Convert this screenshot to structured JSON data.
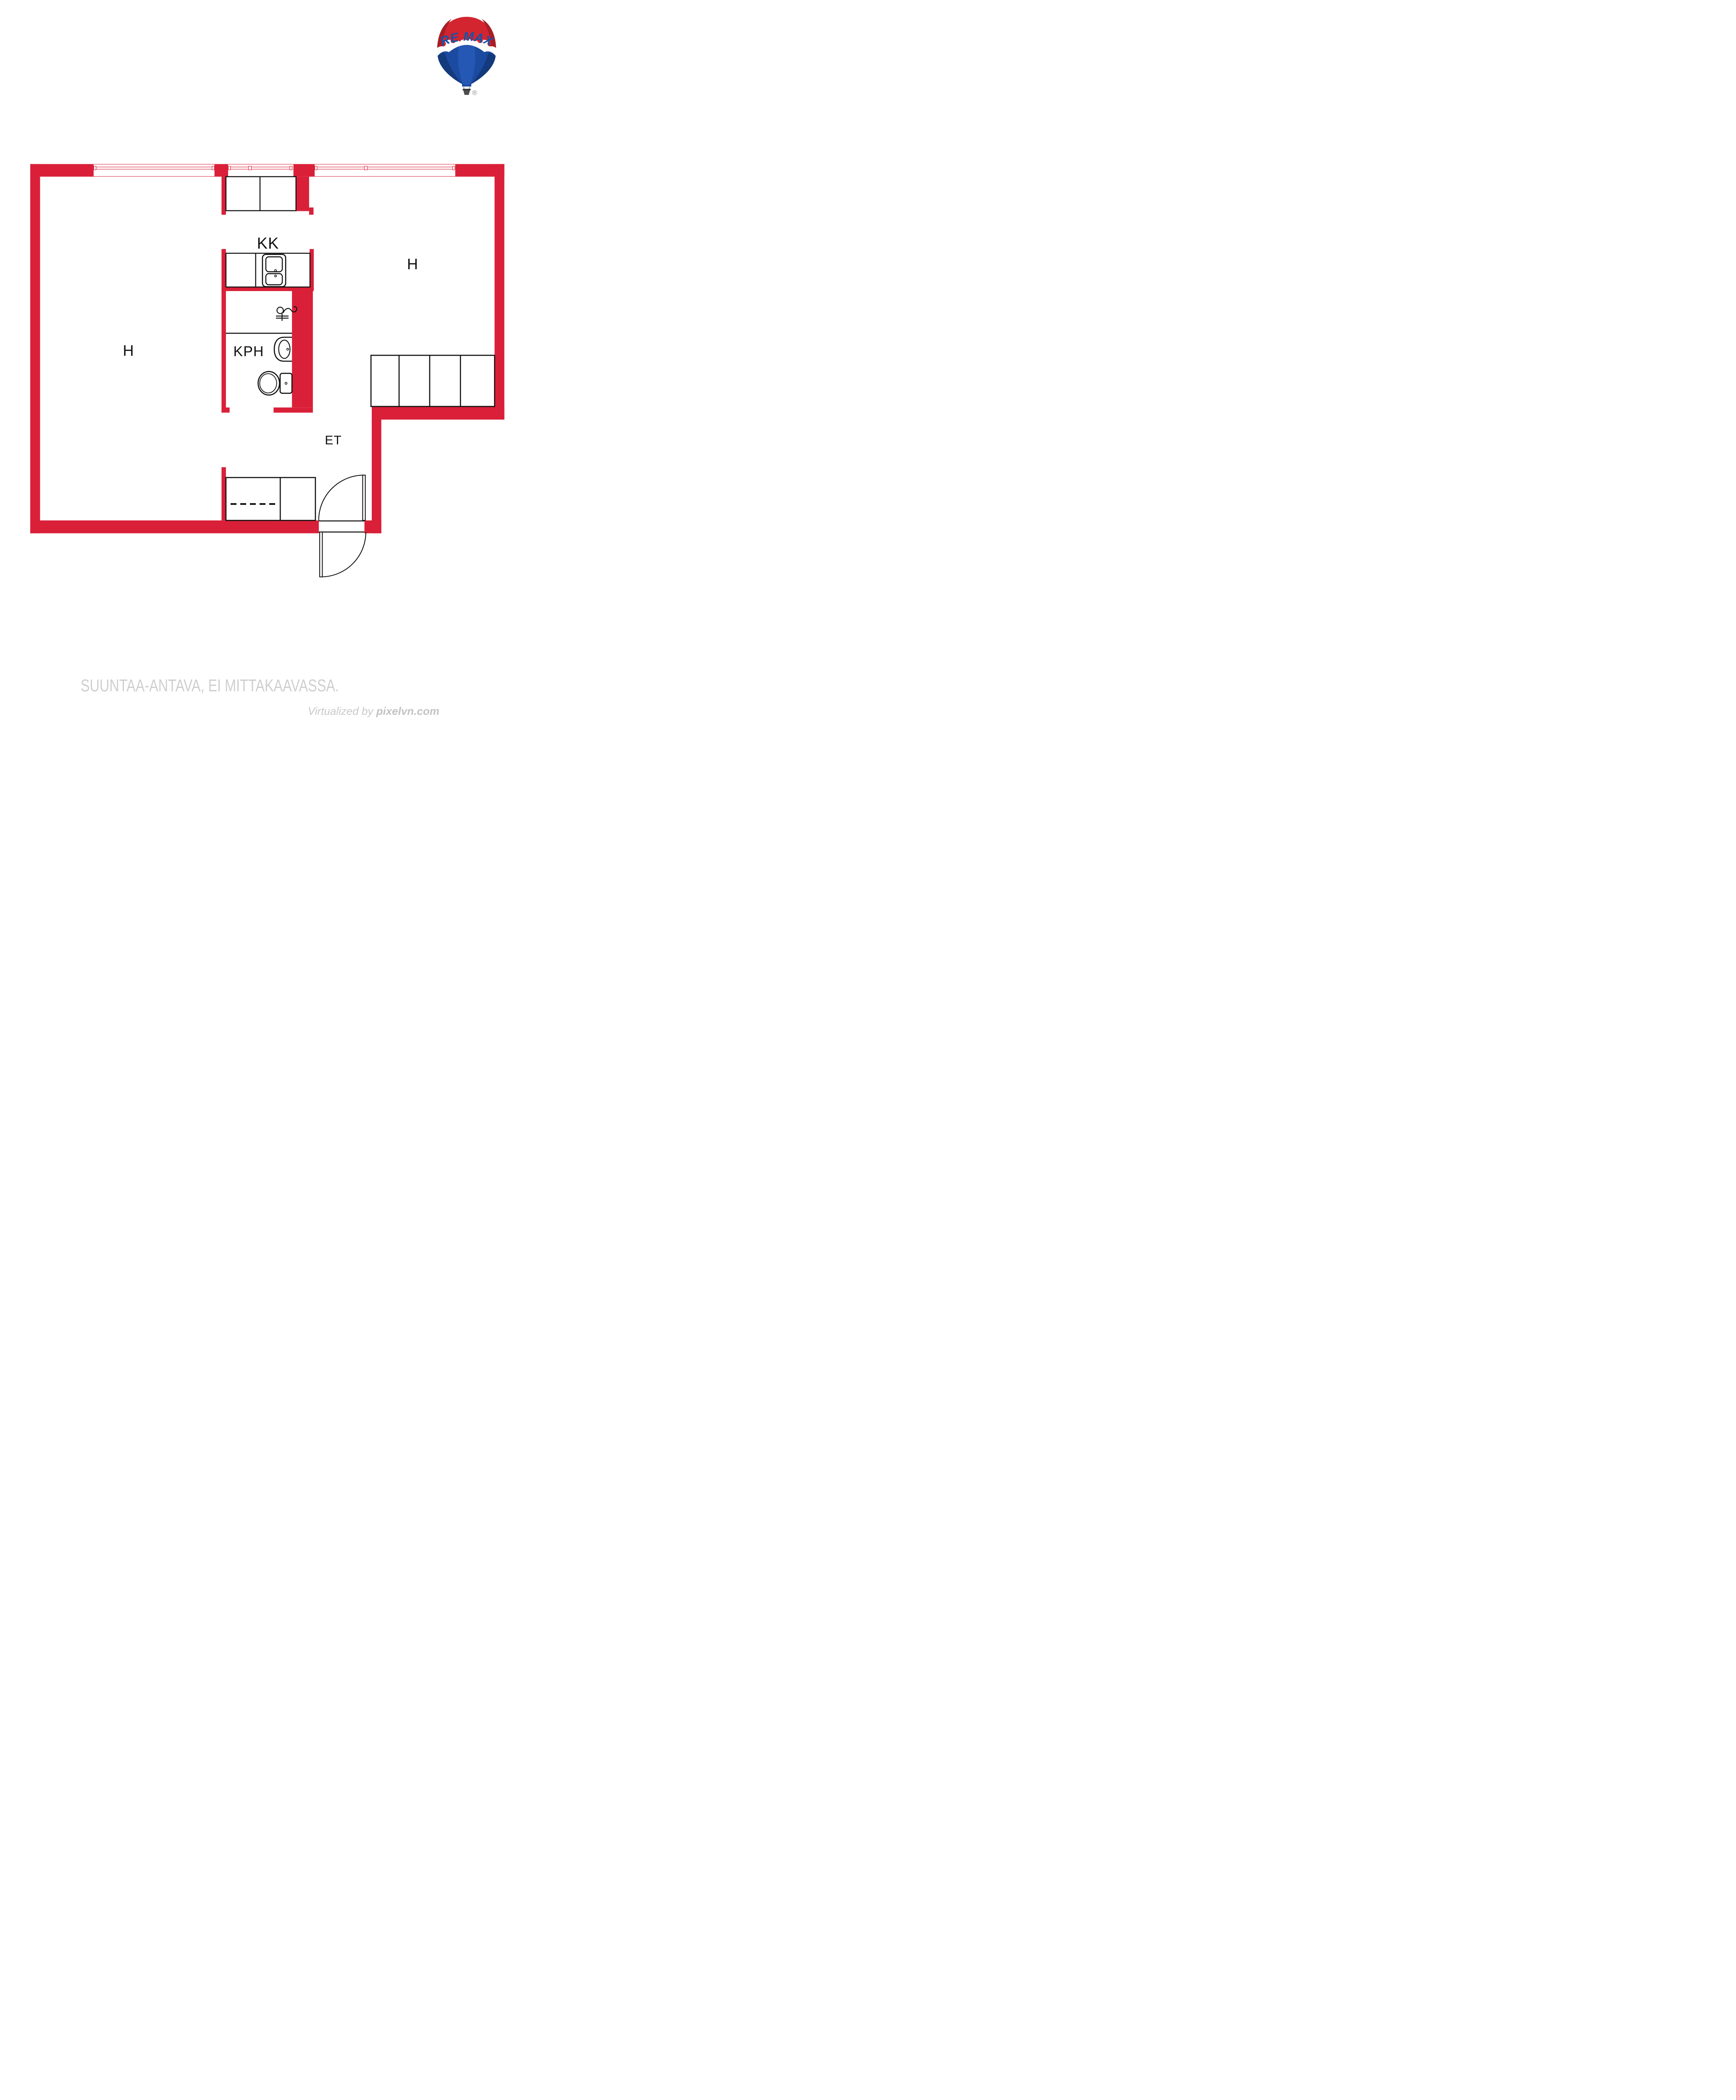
{
  "page": {
    "background_color": "#ffffff",
    "kind": "floor plan"
  },
  "logo": {
    "brand_left": "RE",
    "brand_slash": "/",
    "brand_right": "MAX",
    "registered_mark": "®",
    "colors": {
      "balloon_red": "#D22530",
      "balloon_red_dark": "#A81D26",
      "balloon_blue": "#1B4BA0",
      "balloon_blue_dark": "#143A7E",
      "balloon_blue_light": "#2558B4",
      "wordmark_blue": "#1652A8",
      "slash_red": "#DC2430",
      "basket_gray": "#4E4E4E",
      "registered_gray": "#8D8D8D"
    }
  },
  "floorplan": {
    "wall_color": "#D92038",
    "line_color": "#101010",
    "rooms": [
      {
        "id": "room-h-left",
        "label": "H"
      },
      {
        "id": "room-h-right",
        "label": "H"
      },
      {
        "id": "kitchenette",
        "label": "KK"
      },
      {
        "id": "bathroom",
        "label": "KPH"
      },
      {
        "id": "entry-hall",
        "label": "ET"
      }
    ],
    "fixtures": [
      "double-bowl kitchen sink",
      "faucet symbol",
      "washbasin",
      "toilet",
      "top closet (2 doors)",
      "closet row (4 doors)",
      "wardrobe with hanging-rail dashed line",
      "double-swing entry door",
      "three windows with mullions"
    ]
  },
  "footer": {
    "disclaimer": "SUUNTAA-ANTAVA, EI MITTAKAAVASSA.",
    "credit_prefix": "Virtualized by ",
    "credit_site": "pixelvn.com",
    "text_color": "#cfcfcf"
  }
}
